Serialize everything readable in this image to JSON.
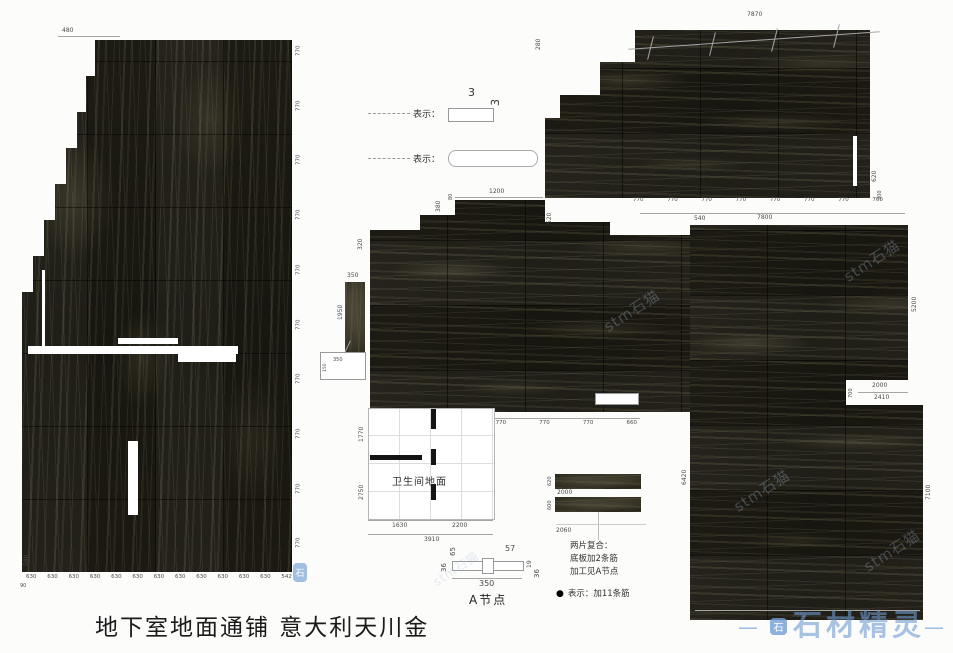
{
  "title": "地下室地面通铺  意大利天川金",
  "legend": {
    "item1_label": "表示：",
    "item2_label": "表示：",
    "thickness_top": "3",
    "thickness_side": "3"
  },
  "left_panel": {
    "top_dim": "480",
    "side_dim": "580",
    "corner_dim": "90",
    "right_dims": [
      "770",
      "770",
      "770",
      "770",
      "770",
      "770",
      "770",
      "770",
      "770",
      "770"
    ],
    "bottom_dims": [
      "630",
      "630",
      "630",
      "630",
      "630",
      "630",
      "630",
      "630",
      "630",
      "630",
      "630",
      "630",
      "542"
    ]
  },
  "top_right_panel": {
    "total_top": "7870",
    "left_dim": "280",
    "right_dim_upper": "620",
    "right_dim_lower": "300",
    "bottom_dims": [
      "770",
      "770",
      "770",
      "770",
      "770",
      "770",
      "770",
      "700"
    ],
    "total_bottom": "7800"
  },
  "center_panel": {
    "top_dim": "1200",
    "top_small_dim": "80",
    "left_dim_a": "380",
    "left_dim_b": "320",
    "right_dim": "520",
    "strip_top_dim": "350",
    "strip_side_dim": "1950",
    "callout_dim": "350",
    "callout_side_dim": "150",
    "bottom_dims": [
      "650",
      "770",
      "770",
      "770",
      "660"
    ]
  },
  "bathroom": {
    "label": "卫生间地面",
    "left_dim_a": "1770",
    "left_dim_b": "2750",
    "bottom_dim_a": "1630",
    "bottom_dim_b": "2200",
    "total": "3910"
  },
  "notes": {
    "strip1_dim": "2000",
    "strip2_dim": "2060",
    "side_dim1": "620",
    "side_dim2": "600",
    "text": "两片复合：\n底板加2条筋\n加工见A节点",
    "bullet": "●",
    "bullet_text": "表示：加11条筋"
  },
  "a_node": {
    "label": "A节点",
    "dim_top_left": "65",
    "dim_top_right": "57",
    "dim_left": "36",
    "dim_right_a": "19",
    "dim_right_b": "36",
    "dim_bottom": "350"
  },
  "right_panel": {
    "top_dim": "540",
    "right_dim_upper": "5200",
    "right_dim_lower": "7100",
    "left_dim": "6420",
    "bottom_dim": "7580",
    "notch_dim_a": "2000",
    "notch_dim_b": "2410",
    "notch_side_dim": "700"
  },
  "watermark": {
    "brand": "石材精灵",
    "dash": "—",
    "icon_glyph": "石",
    "diagonal": "stm石猫"
  }
}
